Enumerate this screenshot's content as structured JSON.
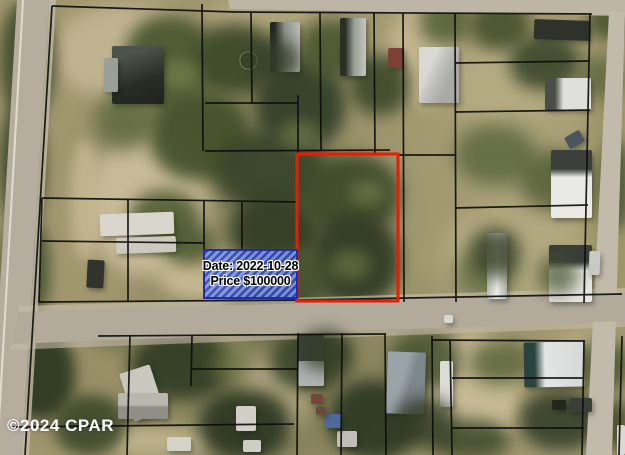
{
  "map": {
    "kind": "satellite-parcel-map",
    "watermark": {
      "text": "©2024 CPAR"
    },
    "sold_parcel_overlay": {
      "date_label": "Date: 2022-10-28",
      "price_label": "Price $100000",
      "fill_color": "#4d63cf",
      "border_color": "#1f2db5"
    },
    "subject_parcel": {
      "outline_color": "#ee1b02"
    },
    "parcel_line_color": "#0e0e0e",
    "road_color": "#b5ae9f"
  }
}
